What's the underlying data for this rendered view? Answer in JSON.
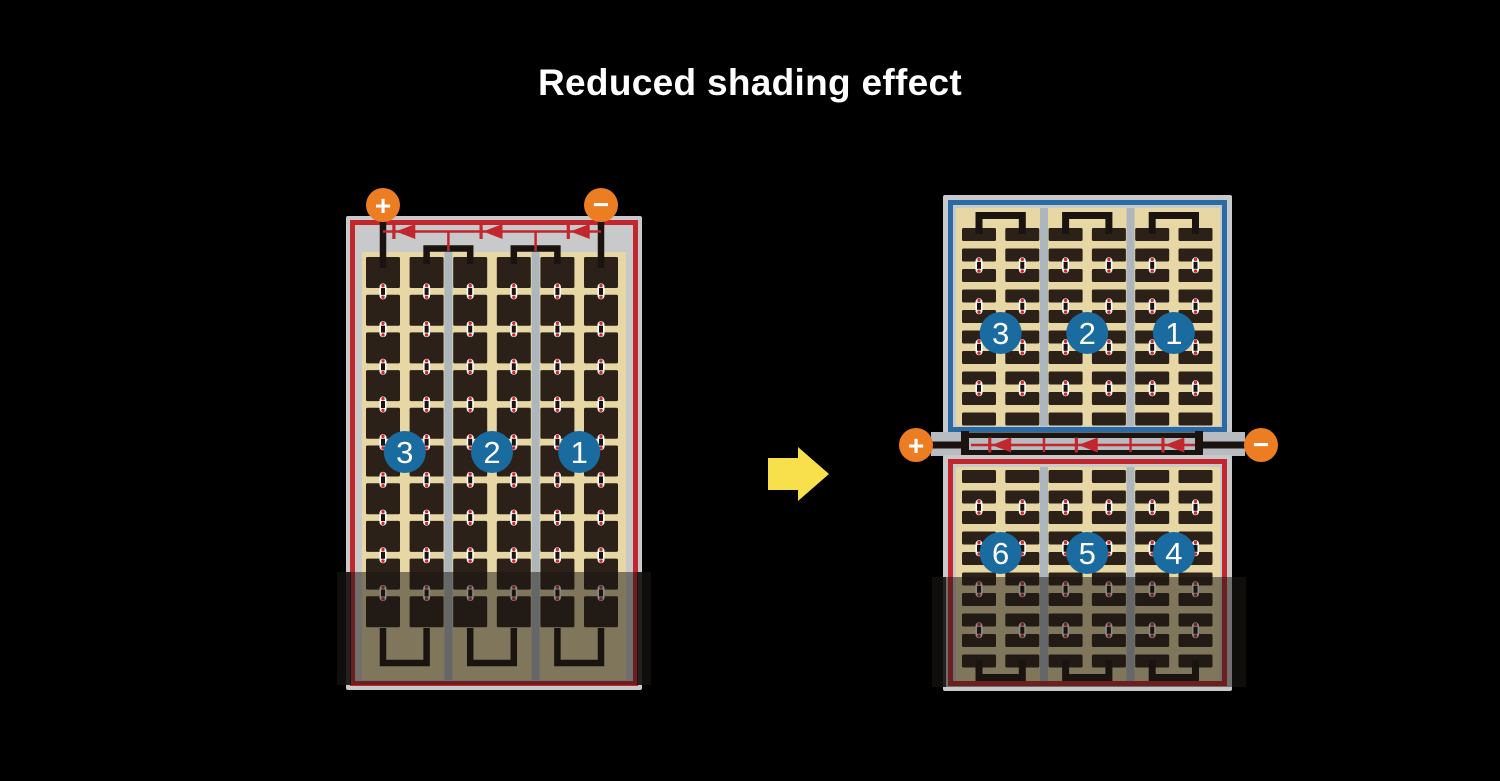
{
  "title": "Reduced shading effect",
  "terminals": {
    "positive": "+",
    "negative": "−"
  },
  "left_module": {
    "group_labels": [
      "3",
      "2",
      "1"
    ],
    "cell_columns": 6,
    "cell_rows": 10,
    "strings": 3
  },
  "right_top_module": {
    "group_labels": [
      "3",
      "2",
      "1"
    ],
    "cell_columns": 6,
    "cell_rows": 10,
    "strings": 3
  },
  "right_bottom_module": {
    "group_labels": [
      "6",
      "5",
      "4"
    ],
    "cell_columns": 6,
    "cell_rows": 10,
    "strings": 3
  },
  "colors": {
    "background": "#000000",
    "title_text": "#ffffff",
    "panel_frame": "#c8c9ca",
    "cell_area_tan": "#e7d7a4",
    "cell_dark": "#2b2118",
    "separator_gray": "#aeb6bd",
    "accent_red": "#c1272d",
    "accent_blue": "#2a6ba5",
    "terminal_orange": "#ed7d23",
    "badge_blue": "#1a6ba0",
    "wire_black": "#1a1310",
    "junction_strip": "#b8bcc0",
    "arrow_yellow": "#f8e04c",
    "shade_overlay": "rgba(25,21,18,0.5)",
    "shade_cap": "rgba(18,15,13,0.8)",
    "pill_white": "#ffffff",
    "pill_dot_red": "#cc2a2a"
  }
}
